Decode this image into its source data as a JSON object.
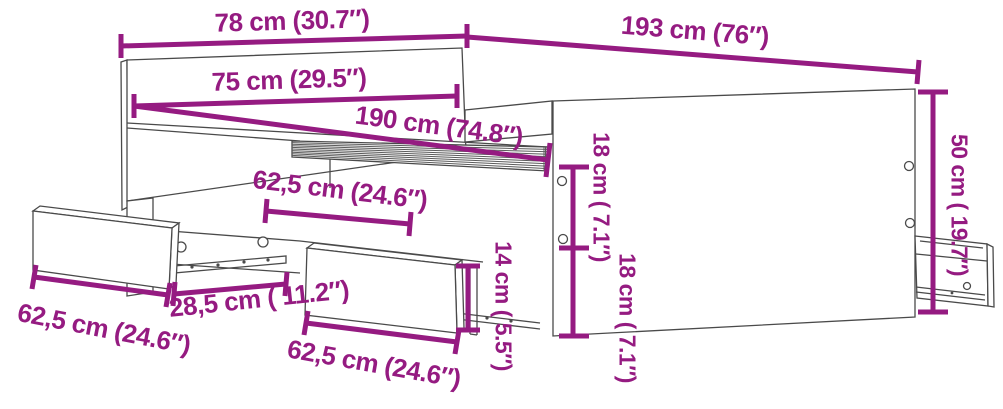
{
  "diagram": {
    "subject": "bed-frame-with-storage-drawers-dimension-diagram",
    "colors": {
      "dimension_accent": "#951B81",
      "outline": "#4A4A4A",
      "background": "#FFFFFF"
    },
    "dims": {
      "headboard_width": "78 cm (30.7″)",
      "frame_length": "193 cm (76″)",
      "mattress_width": "75 cm (29.5″)",
      "mattress_length": "190 cm (74.8″)",
      "upper_side_height": "18 cm ( 7.1″)",
      "lower_side_height": "18 cm ( 7.1″)",
      "total_height": "50 cm ( 19.7″)",
      "drawer_front_height": "14 cm ( 5.5″)",
      "drawer_width_top": "62,5 cm (24.6″)",
      "drawer_width_left": "62,5 cm (24.6″)",
      "drawer_width_bottom": "62,5 cm (24.6″)",
      "rail_length": "28,5 cm ( 11.2″)"
    }
  }
}
